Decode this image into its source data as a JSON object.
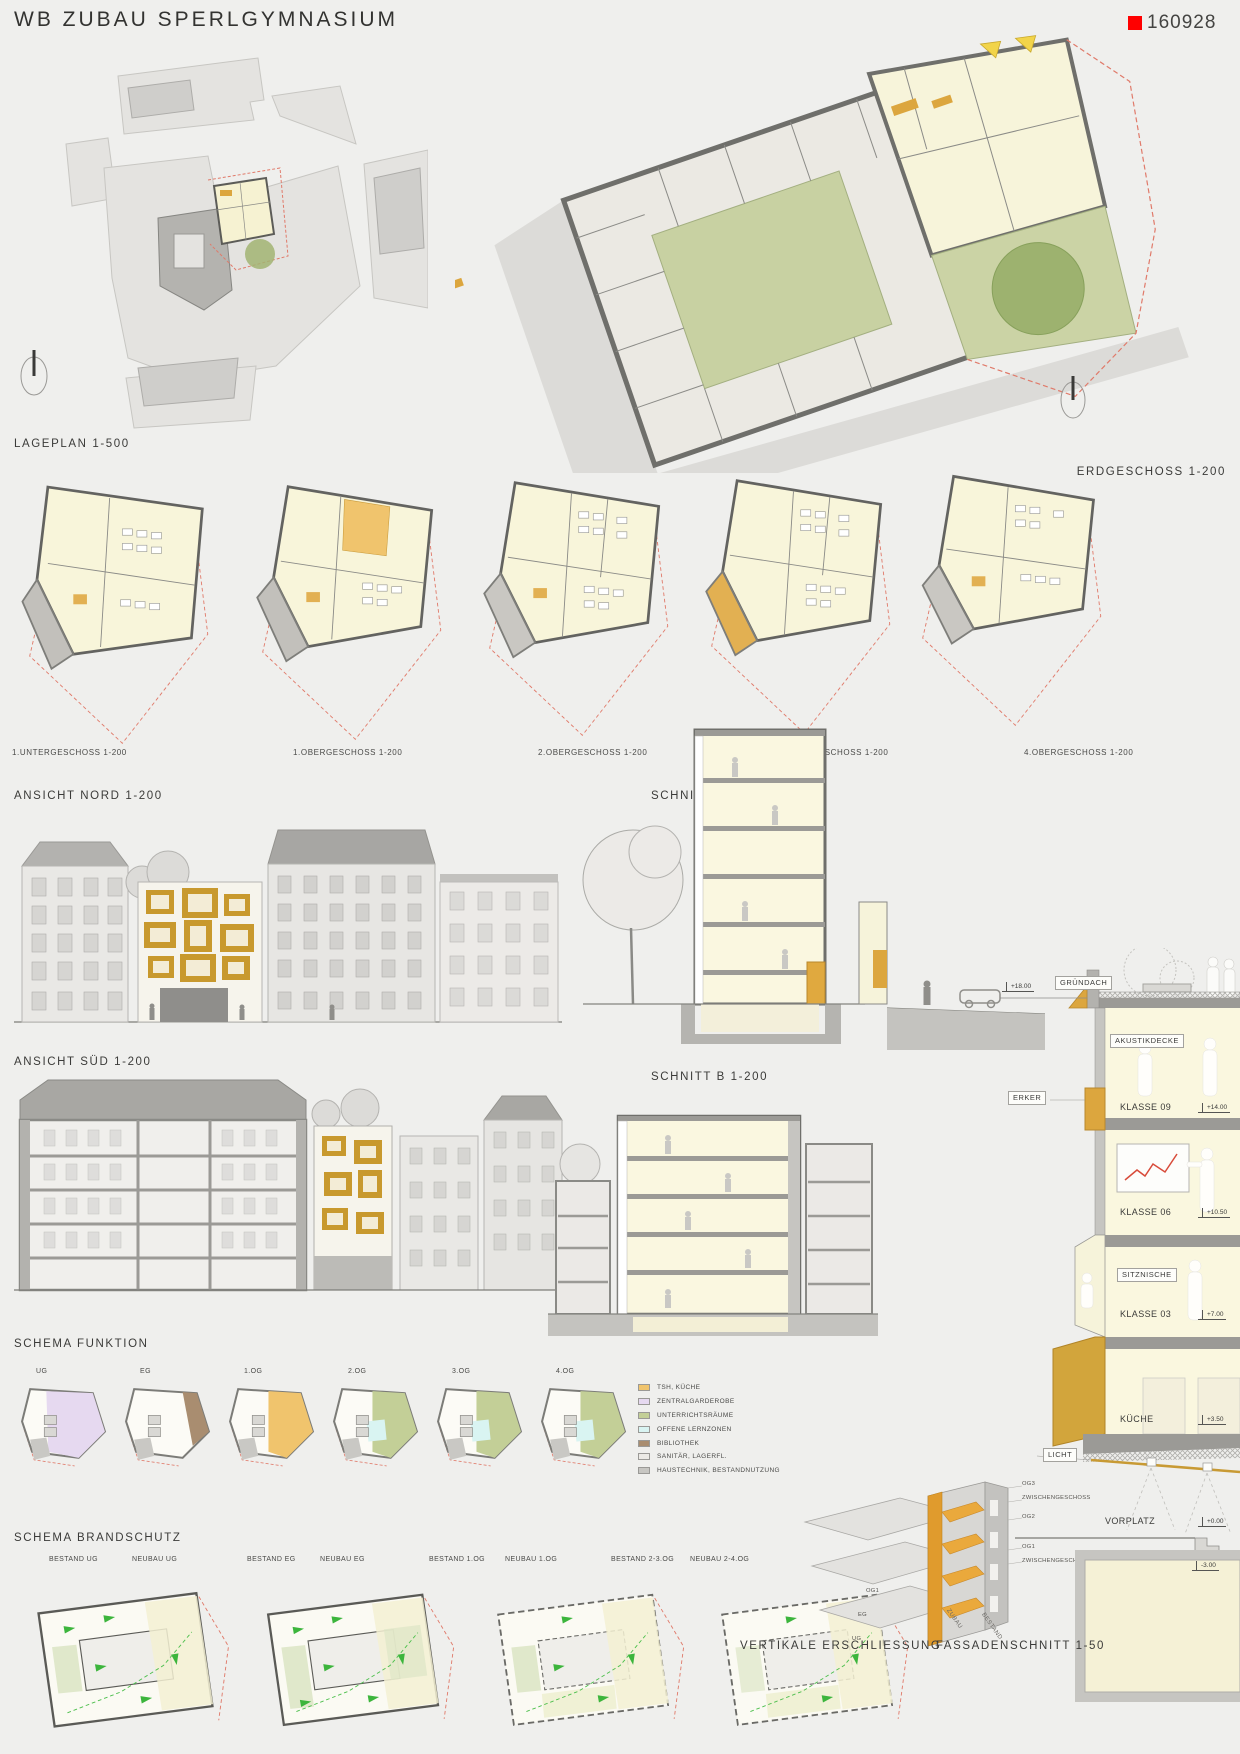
{
  "header": {
    "title": "WB ZUBAU SPERLGYMNASIUM",
    "code": "160928"
  },
  "colors": {
    "accent_red": "#ff0000",
    "gold": "#dca63e",
    "courtyard_green": "#c8d1a2",
    "escape_green": "#3cb53c",
    "boundary_red": "#e07a6a"
  },
  "labels": {
    "lageplan": "LAGEPLAN 1-500",
    "erdgeschoss": "ERDGESCHOSS 1-200",
    "ansicht_nord": "ANSICHT NORD 1-200",
    "schnitt_a": "SCHNITT A 1-200",
    "ansicht_sued": "ANSICHT SÜD 1-200",
    "schnitt_b": "SCHNITT B 1-200",
    "schema_funktion": "SCHEMA FUNKTION",
    "schema_brandschutz": "SCHEMA BRANDSCHUTZ",
    "vertikale_erschliessung": "VERTIKALE ERSCHLIESSUNG",
    "fassadenschnitt": "FASSADENSCHNITT 1-50"
  },
  "floor_plans": [
    "1.UNTERGESCHOSS 1-200",
    "1.OBERGESCHOSS 1-200",
    "2.OBERGESCHOSS 1-200",
    "3.OBERGESCHOSS 1-200",
    "4.OBERGESCHOSS 1-200"
  ],
  "schema_funktion": {
    "floors": [
      "UG",
      "EG",
      "1.OG",
      "2.OG",
      "3.OG",
      "4.OG"
    ],
    "legend": [
      {
        "label": "TSH, KÜCHE",
        "color": "#f0c46d"
      },
      {
        "label": "ZENTRALGARDEROBE",
        "color": "#e6d9f0"
      },
      {
        "label": "UNTERRICHTSRÄUME",
        "color": "#c3cf97"
      },
      {
        "label": "OFFENE LERNZONEN",
        "color": "#d9f4f2"
      },
      {
        "label": "BIBLIOTHEK",
        "color": "#a98d70"
      },
      {
        "label": "SANITÄR, LAGERFL.",
        "color": "#eceae6"
      },
      {
        "label": "HAUSTECHNIK, BESTANDNUTZUNG",
        "color": "#c7c6c2"
      }
    ]
  },
  "schema_brandschutz": [
    "BESTAND UG",
    "NEUBAU UG",
    "BESTAND EG",
    "NEUBAU EG",
    "BESTAND 1.OG",
    "NEUBAU 1.OG",
    "BESTAND 2-3.OG",
    "NEUBAU 2-4.OG"
  ],
  "vertikale": {
    "right_labels": [
      "OG3",
      "ZWISCHENGESCHOSS",
      "OG2",
      "OG1",
      "ZWISCHENGESCHOSS"
    ],
    "left_labels": [
      "OG1",
      "EG",
      "UG"
    ],
    "wing_labels": [
      "ZUBAU",
      "BESTAND"
    ]
  },
  "fassade": {
    "annotations": {
      "gruendach": "GRÜNDACH",
      "akustikdecke": "AKUSTIKDECKE",
      "erker": "ERKER",
      "sitznische": "SITZNISCHE",
      "licht": "LICHT",
      "vorplatz": "VORPLATZ"
    },
    "rooms": [
      {
        "name": "KLASSE 09",
        "level": "+14.00"
      },
      {
        "name": "KLASSE 06",
        "level": "+10.50"
      },
      {
        "name": "KLASSE 03",
        "level": "+7.00"
      },
      {
        "name": "KÜCHE",
        "level": "+3.50"
      }
    ],
    "levels": {
      "roof": "+18.00",
      "ground": "+0.00",
      "basement": "-3.00"
    }
  }
}
